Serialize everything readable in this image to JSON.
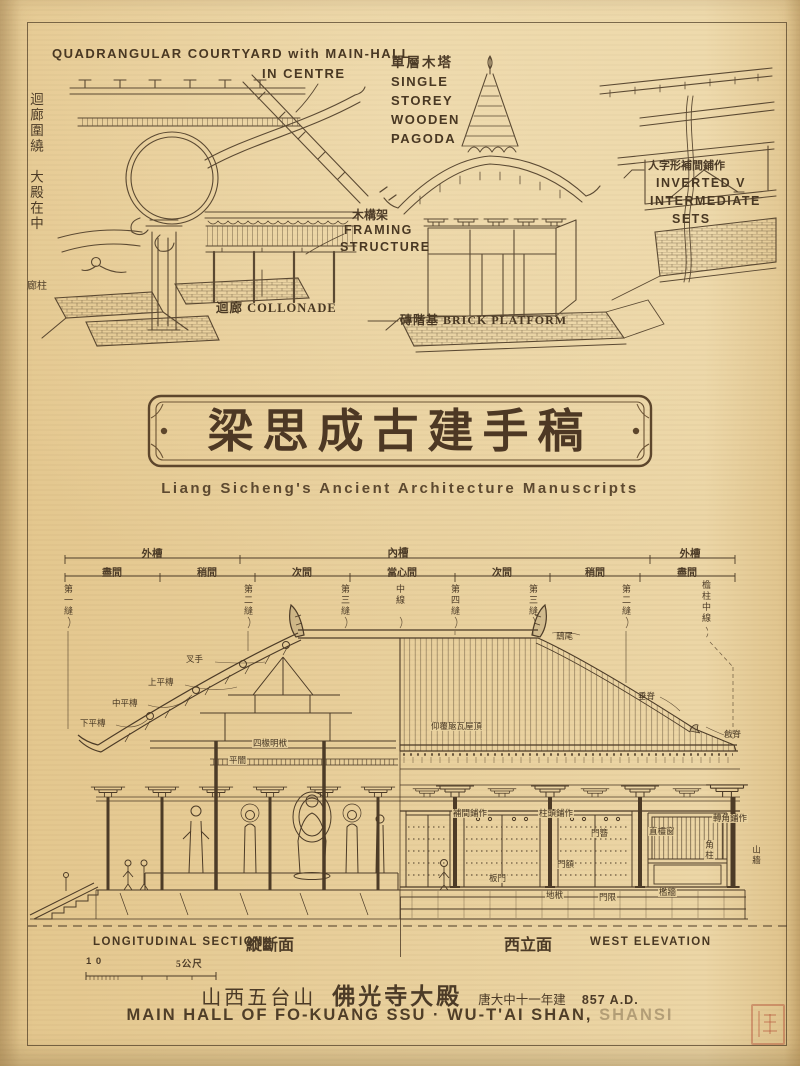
{
  "colors": {
    "paper": "#e7cd97",
    "ink": "#4c3b27",
    "seal_red": "#b04630"
  },
  "top_left": {
    "heading1": "QUADRANGULAR COURTYARD with MAIN-HALL",
    "heading2": "IN CENTRE",
    "vertical_note": "迴廊圍繞　大殿在中",
    "corner_note": "廊柱",
    "colonnade": "迴廊 COLLONADE"
  },
  "framing": {
    "cn": "木構架",
    "en1": "FRAMING",
    "en2": "STRUCTURE"
  },
  "pagoda": {
    "cn": "單層木塔",
    "en": [
      "SINGLE",
      "STOREY",
      "WOODEN",
      "PAGODA"
    ],
    "platform": "磚階基 BRICK PLATFORM"
  },
  "inverted": {
    "cn": "人字形補間鋪作",
    "en1": "INVERTED V",
    "en2": "INTERMEDIATE",
    "en3": "SETS"
  },
  "title": {
    "cn": "梁思成古建手稿",
    "en": "Liang Sicheng's Ancient Architecture Manuscripts"
  },
  "dims": {
    "outer_left": "外槽",
    "inner": "內槽",
    "outer_right": "外槽",
    "bays": [
      "盡間",
      "稍間",
      "次間",
      "當心間",
      "次間",
      "稍間",
      "盡間"
    ],
    "axes": [
      "第一縫",
      "第二縫",
      "第三縫",
      "中線",
      "第四縫",
      "第三縫",
      "第二縫",
      "檐柱中線"
    ]
  },
  "ann": {
    "chiwei": "鴟尾",
    "chuiji": "垂脊",
    "qiangji": "戧脊",
    "roof_tiles": "仰覆瓪瓦屋頂",
    "chashou": "叉手",
    "shang": "上平槫",
    "zhongp": "中平槫",
    "xiap": "下平槫",
    "pingan": "平闇",
    "mingfu": "四椽明栿",
    "zhutou": "柱頭鋪作",
    "bujian": "補間鋪作",
    "zhuanjiao": "轉角鋪作",
    "menzan": "門簪",
    "mene": "門額",
    "banmen": "板門",
    "difu": "地栿",
    "menxian": "門限",
    "chuang": "直欞窗",
    "kanqiang": "檻牆",
    "jiaozhu": "角柱",
    "shanqiang": "山牆"
  },
  "captions": {
    "section_en": "LONGITUDINAL SECTION",
    "section_cn": "縱斷面",
    "elev_cn": "西立面",
    "elev_en": "WEST ELEVATION",
    "scale_start": "1 0",
    "scale_end": "5公尺"
  },
  "footer": {
    "site": "山西五台山",
    "hall": "佛光寺大殿",
    "era": "唐大中十一年建",
    "year": "857 A.D.",
    "en_main": "MAIN HALL OF FO-KUANG SSU · WU-T'AI SHAN,",
    "en_faded": "SHANSI"
  }
}
